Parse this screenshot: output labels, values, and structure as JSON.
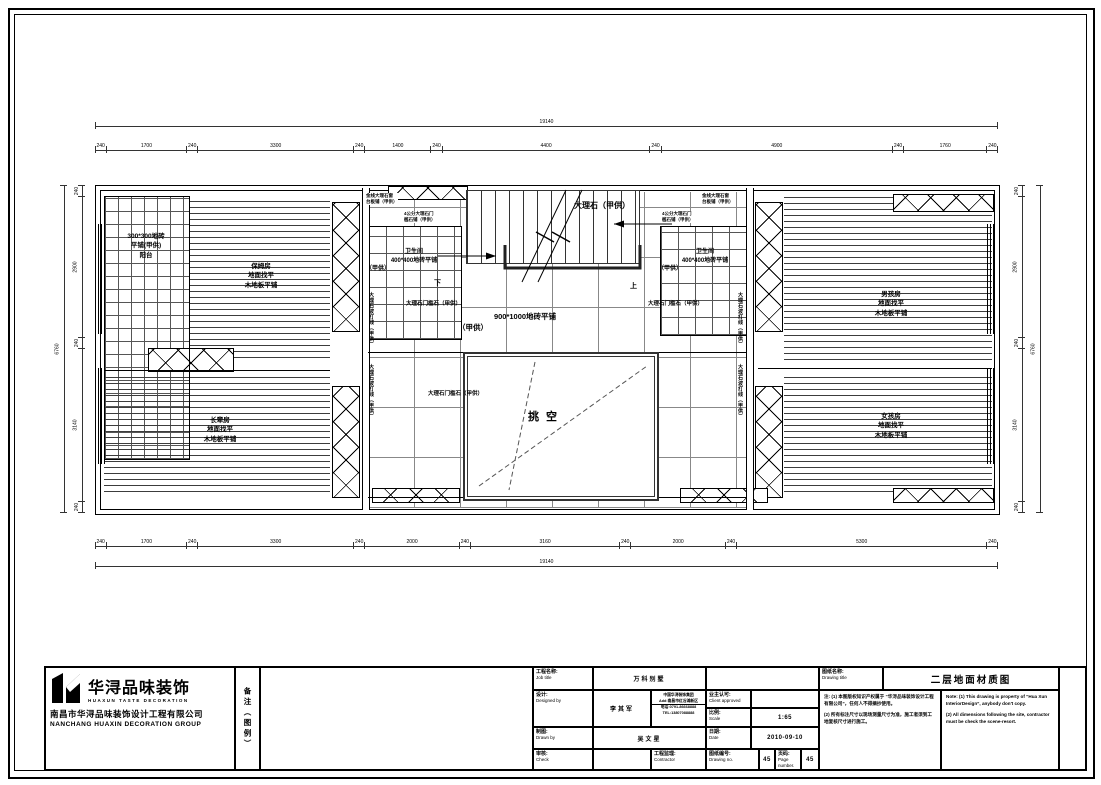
{
  "title_block": {
    "logo": {
      "brand": "华浔品味装饰",
      "brand_sub": "HUAXUN TASTE DECORATION",
      "company_cn": "南昌市华浔品味装饰设计工程有限公司",
      "company_en": "NANCHANG HUAXIN DECORATION GROUP"
    },
    "remark_vertical": "备注（图例）",
    "job": {
      "label_cn": "工程名称:",
      "label_en": "Job title",
      "value": "万科别墅"
    },
    "designed": {
      "label_cn": "设计:",
      "label_en": "Designed by",
      "value": "李其军"
    },
    "contact": {
      "line1": "中国华浔装饰集团",
      "line2": "Add:南昌市红谷滩新区",
      "line3": "电话:0791-86668888",
      "line4": "TEL:13807088888"
    },
    "client": {
      "label_cn": "业主认可:",
      "label_en": "Client approved",
      "value": ""
    },
    "scale": {
      "label_cn": "比例:",
      "label_en": "Scale",
      "value": "1:65"
    },
    "drawn": {
      "label_cn": "制图:",
      "label_en": "Drawn by",
      "value": "吴文星"
    },
    "date": {
      "label_cn": "日期:",
      "label_en": "Date",
      "value": "2010-09-10"
    },
    "check": {
      "label_cn": "审核:",
      "label_en": "Check",
      "value": ""
    },
    "contractor": {
      "label_cn": "工程监理:",
      "label_en": "Contractor",
      "value": ""
    },
    "drawing_no": {
      "label_cn": "图纸编号:",
      "label_en": "Drawing no.",
      "value": "45"
    },
    "page": {
      "label_cn": "页码:",
      "label_en": "Page number.",
      "value": "45"
    },
    "drawing_title": {
      "label_cn": "图纸名称:",
      "label_en": "Drawing title",
      "value": "二层地面材质图"
    },
    "notes": {
      "cn1": "注: (1) 本图版权知识产权属于 “华浔品味装饰设计工程有限公司”，任何人不得摘抄使用。",
      "cn2": "(2) 所有标注尺寸以现场测量尺寸为准，施工者须到工地复核尺寸进行施工。",
      "en1": "Note: (1) This drawing is property of “Hua Xun InteriorDesign”, anybody don't copy.",
      "en2": "(2) All dimensions following the site, contractor must be check the scene-resort."
    }
  },
  "plan": {
    "rooms": {
      "balcony": {
        "lines": [
          "300*300地砖",
          "平铺(甲供)",
          "阳台"
        ]
      },
      "nanny": {
        "lines": [
          "保姆房",
          "地面找平",
          "木地板平铺"
        ]
      },
      "elder": {
        "lines": [
          "长辈房",
          "地面找平",
          "木地板平铺"
        ]
      },
      "boy": {
        "lines": [
          "男孩房",
          "地面找平",
          "木地板平铺"
        ]
      },
      "girl": {
        "lines": [
          "女孩房",
          "地面找平",
          "木地板平铺"
        ]
      },
      "bath_left": {
        "lines": [
          "卫生间",
          "400*400地砖平铺",
          "（甲供）"
        ]
      },
      "bath_right": {
        "lines": [
          "卫生间",
          "400*400地砖平铺",
          "（甲供）"
        ]
      },
      "corridor": {
        "lines": [
          "900*1000地砖平铺",
          "（甲供）"
        ]
      }
    },
    "annotations": {
      "stair_marble": "大理石（甲供）",
      "threshold": "大理石门槛石（甲供）",
      "wave": "大理石波打线（甲供）",
      "sill_l1": "金线大理石窗",
      "sill_l2": "台板铺（甲供）",
      "thresh_l1": "4公分大理石门",
      "thresh_l2": "槛石铺（甲供）",
      "void": "挑空",
      "up": "上",
      "down": "下"
    }
  },
  "dimensions": {
    "top_overall": [
      "19140"
    ],
    "top": [
      "240",
      "1700",
      "240",
      "3300",
      "240",
      "1400",
      "240",
      "4400",
      "240",
      "4900",
      "240",
      "1760",
      "240"
    ],
    "bottom": [
      "240",
      "1700",
      "240",
      "3300",
      "240",
      "2000",
      "240",
      "3160",
      "240",
      "2000",
      "240",
      "5300",
      "240"
    ],
    "bottom_overall": [
      "19140"
    ],
    "left": [
      "240",
      "2900",
      "240",
      "3140",
      "240"
    ],
    "left_overall": [
      "6760"
    ],
    "right": [
      "240",
      "2900",
      "240",
      "3140",
      "240"
    ],
    "right_overall": [
      "6760"
    ]
  }
}
